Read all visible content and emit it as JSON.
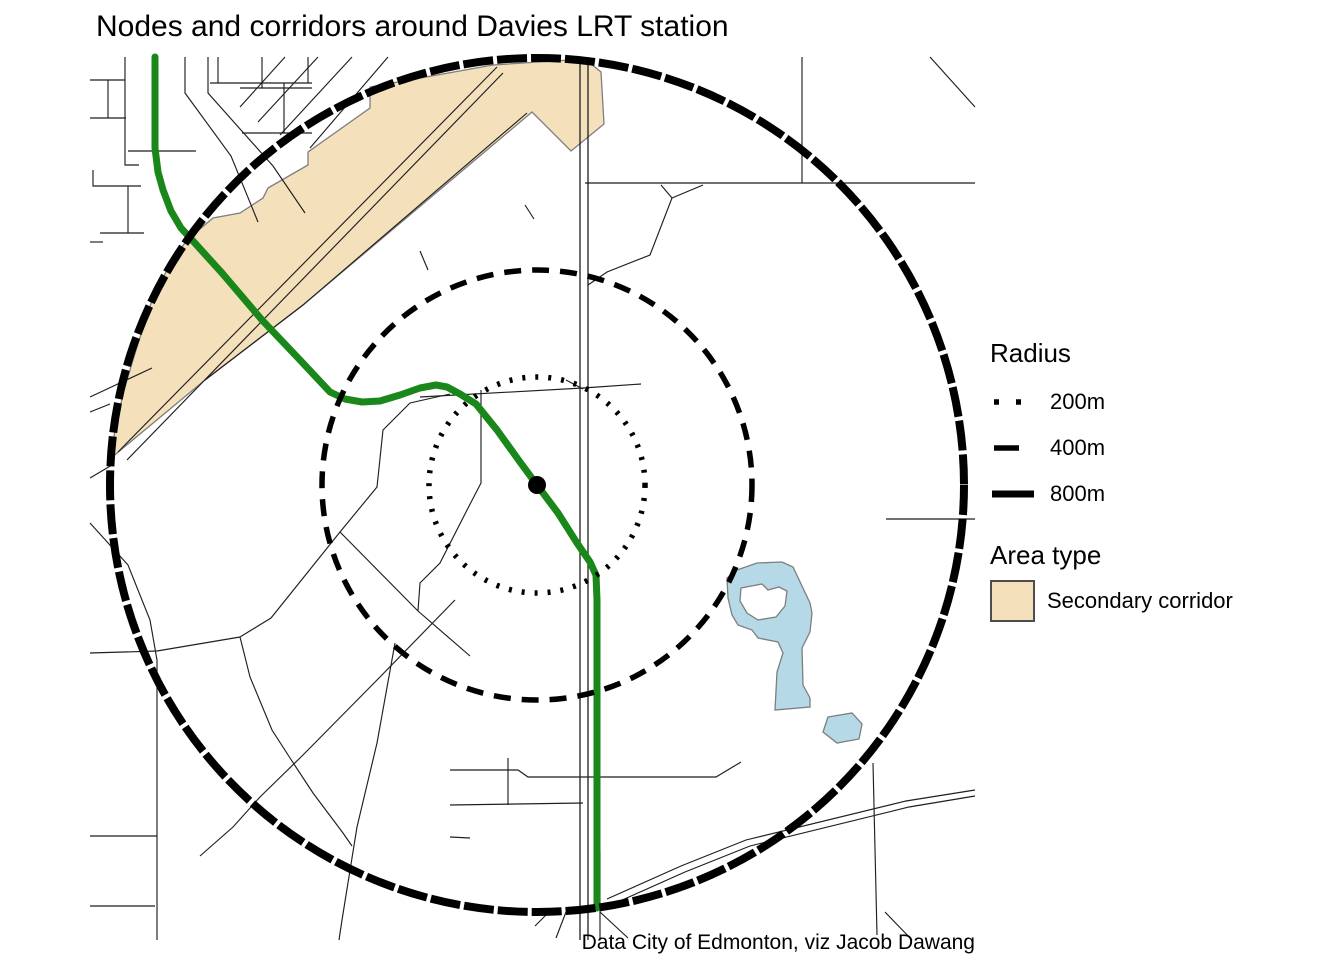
{
  "title": "Nodes and corridors around Davies LRT station",
  "caption": "Data City of Edmonton, viz Jacob Dawang",
  "legend": {
    "radius": {
      "title": "Radius",
      "items": [
        {
          "label": "200m",
          "style": "dotted"
        },
        {
          "label": "400m",
          "style": "dashed"
        },
        {
          "label": "800m",
          "style": "solid"
        }
      ]
    },
    "area_type": {
      "title": "Area type",
      "items": [
        {
          "label": "Secondary corridor",
          "fill": "#f4e1bc"
        }
      ]
    }
  },
  "chart_data": {
    "type": "map",
    "title": "Nodes and corridors around Davies LRT station",
    "station": {
      "name": "Davies LRT station",
      "x": 537,
      "y": 485,
      "marker": "black-dot"
    },
    "rings": [
      {
        "radius_m": 200,
        "style": "dotted",
        "r_px": 108
      },
      {
        "radius_m": 400,
        "style": "dashed",
        "r_px": 215
      },
      {
        "radius_m": 800,
        "style": "solid",
        "r_px": 427
      }
    ],
    "colors": {
      "corridor": "#f4e1bc",
      "water": "#b6d9e8",
      "lrt": "#198719",
      "road": "#1f1f1f",
      "ring": "#000000",
      "poly_border": "#7e7e7e"
    },
    "layers": {
      "secondary_corridor": [
        [
          [
            111,
            458
          ],
          [
            115,
            430
          ],
          [
            124,
            390
          ],
          [
            136,
            350
          ],
          [
            152,
            300
          ],
          [
            170,
            264
          ],
          [
            187,
            240
          ],
          [
            213,
            218
          ],
          [
            240,
            213
          ],
          [
            263,
            198
          ],
          [
            268,
            188
          ],
          [
            308,
            165
          ],
          [
            308,
            152
          ],
          [
            370,
            108
          ],
          [
            370,
            87
          ],
          [
            493,
            65
          ],
          [
            585,
            59
          ],
          [
            601,
            72
          ],
          [
            604,
            124
          ],
          [
            571,
            151
          ],
          [
            532,
            112
          ],
          [
            303,
            305
          ],
          [
            205,
            380
          ]
        ]
      ],
      "water": [
        {
          "outer": [
            [
              737,
              570
            ],
            [
              757,
              563
            ],
            [
              782,
              562
            ],
            [
              793,
              567
            ],
            [
              810,
              603
            ],
            [
              812,
              613
            ],
            [
              810,
              632
            ],
            [
              802,
              648
            ],
            [
              803,
              685
            ],
            [
              810,
              698
            ],
            [
              810,
              707
            ],
            [
              775,
              710
            ],
            [
              777,
              672
            ],
            [
              783,
              653
            ],
            [
              778,
              642
            ],
            [
              758,
              638
            ],
            [
              752,
              630
            ],
            [
              738,
              625
            ],
            [
              732,
              615
            ],
            [
              728,
              598
            ],
            [
              727,
              578
            ]
          ],
          "holes": [
            [
              [
                741,
                588
              ],
              [
                762,
                584
              ],
              [
                768,
                590
              ],
              [
                779,
                587
              ],
              [
                787,
                591
              ],
              [
                785,
                606
              ],
              [
                776,
                617
              ],
              [
                758,
                620
              ],
              [
                747,
                613
              ],
              [
                740,
                601
              ]
            ]
          ]
        },
        {
          "outer": [
            [
              828,
              717
            ],
            [
              852,
              713
            ],
            [
              862,
              724
            ],
            [
              859,
              739
            ],
            [
              837,
              743
            ],
            [
              823,
              732
            ]
          ],
          "holes": []
        }
      ],
      "roads": [
        [
          [
            90,
            80
          ],
          [
            125,
            80
          ]
        ],
        [
          [
            108,
            80
          ],
          [
            108,
            118
          ]
        ],
        [
          [
            90,
            118
          ],
          [
            126,
            118
          ]
        ],
        [
          [
            125,
            57
          ],
          [
            125,
            165
          ],
          [
            139,
            165
          ]
        ],
        [
          [
            93,
            170
          ],
          [
            93,
            186
          ],
          [
            141,
            186
          ]
        ],
        [
          [
            128,
            186
          ],
          [
            128,
            233
          ]
        ],
        [
          [
            100,
            233
          ],
          [
            144,
            233
          ]
        ],
        [
          [
            90,
            242
          ],
          [
            103,
            242
          ]
        ],
        [
          [
            128,
            151
          ],
          [
            196,
            151
          ]
        ],
        [
          [
            185,
            57
          ],
          [
            185,
            93
          ],
          [
            231,
            156
          ],
          [
            258,
            222
          ]
        ],
        [
          [
            208,
            57
          ],
          [
            208,
            93
          ],
          [
            273,
            166
          ],
          [
            305,
            213
          ]
        ],
        [
          [
            218,
            57
          ],
          [
            218,
            83
          ]
        ],
        [
          [
            210,
            83
          ],
          [
            312,
            83
          ]
        ],
        [
          [
            240,
            88
          ],
          [
            312,
            88
          ]
        ],
        [
          [
            262,
            57
          ],
          [
            262,
            88
          ]
        ],
        [
          [
            284,
            83
          ],
          [
            284,
            133
          ]
        ],
        [
          [
            242,
            133
          ],
          [
            312,
            133
          ]
        ],
        [
          [
            308,
            57
          ],
          [
            308,
            83
          ]
        ],
        [
          [
            285,
            57
          ],
          [
            240,
            107
          ]
        ],
        [
          [
            318,
            57
          ],
          [
            258,
            122
          ]
        ],
        [
          [
            352,
            57
          ],
          [
            280,
            135
          ]
        ],
        [
          [
            388,
            57
          ],
          [
            310,
            148
          ]
        ],
        [
          [
            118,
            452
          ],
          [
            497,
            67
          ]
        ],
        [
          [
            127,
            460
          ],
          [
            503,
            73
          ]
        ],
        [
          [
            420,
            251
          ],
          [
            428,
            270
          ]
        ],
        [
          [
            525,
            205
          ],
          [
            534,
            219
          ]
        ],
        [
          [
            205,
            380
          ],
          [
            303,
            305
          ],
          [
            527,
            113
          ]
        ],
        [
          [
            420,
            397
          ],
          [
            583,
            388
          ],
          [
            641,
            384
          ]
        ],
        [
          [
            566,
            380
          ],
          [
            583,
            389
          ]
        ],
        [
          [
            481,
            390
          ],
          [
            481,
            483
          ],
          [
            466,
            512
          ],
          [
            440,
            563
          ],
          [
            420,
            583
          ],
          [
            418,
            611
          ]
        ],
        [
          [
            450,
            394
          ],
          [
            410,
            403
          ],
          [
            383,
            430
          ],
          [
            377,
            487
          ],
          [
            340,
            532
          ],
          [
            271,
            618
          ],
          [
            240,
            637
          ],
          [
            250,
            677
          ],
          [
            272,
            730
          ],
          [
            290,
            758
          ],
          [
            313,
            793
          ],
          [
            343,
            833
          ],
          [
            352,
            846
          ]
        ],
        [
          [
            340,
            532
          ],
          [
            418,
            611
          ],
          [
            470,
            656
          ]
        ],
        [
          [
            455,
            600
          ],
          [
            380,
            677
          ],
          [
            303,
            755
          ],
          [
            260,
            797
          ],
          [
            233,
            827
          ],
          [
            200,
            856
          ]
        ],
        [
          [
            395,
            643
          ],
          [
            377,
            743
          ],
          [
            357,
            827
          ],
          [
            342,
            920
          ],
          [
            339,
            940
          ]
        ],
        [
          [
            588,
            285
          ],
          [
            607,
            272
          ],
          [
            650,
            255
          ],
          [
            672,
            198
          ],
          [
            661,
            185
          ]
        ],
        [
          [
            672,
            198
          ],
          [
            703,
            185
          ]
        ],
        [
          [
            585,
            183
          ],
          [
            975,
            183
          ]
        ],
        [
          [
            802,
            57
          ],
          [
            802,
            183
          ]
        ],
        [
          [
            930,
            57
          ],
          [
            975,
            107
          ]
        ],
        [
          [
            886,
            519
          ],
          [
            975,
            519
          ]
        ],
        [
          [
            90,
            397
          ],
          [
            152,
            368
          ]
        ],
        [
          [
            90,
            412
          ],
          [
            110,
            404
          ]
        ],
        [
          [
            90,
            478
          ],
          [
            112,
            465
          ]
        ],
        [
          [
            90,
            523
          ],
          [
            128,
            565
          ],
          [
            150,
            620
          ],
          [
            157,
            660
          ],
          [
            157,
            940
          ]
        ],
        [
          [
            90,
            653
          ],
          [
            157,
            651
          ],
          [
            240,
            637
          ]
        ],
        [
          [
            90,
            836
          ],
          [
            157,
            836
          ]
        ],
        [
          [
            90,
            906
          ],
          [
            155,
            906
          ]
        ],
        [
          [
            450,
            770
          ],
          [
            518,
            770
          ],
          [
            528,
            777
          ],
          [
            716,
            777
          ],
          [
            741,
            762
          ]
        ],
        [
          [
            450,
            805
          ],
          [
            583,
            803
          ]
        ],
        [
          [
            508,
            758
          ],
          [
            508,
            805
          ]
        ],
        [
          [
            450,
            837
          ],
          [
            470,
            838
          ]
        ],
        [
          [
            553,
            908
          ],
          [
            535,
            926
          ]
        ],
        [
          [
            566,
            912
          ],
          [
            556,
            938
          ]
        ],
        [
          [
            600,
            852
          ],
          [
            600,
            940
          ]
        ],
        [
          [
            600,
            912
          ],
          [
            628,
            938
          ]
        ],
        [
          [
            607,
            899
          ],
          [
            681,
            866
          ],
          [
            746,
            840
          ],
          [
            906,
            801
          ],
          [
            975,
            790
          ]
        ],
        [
          [
            611,
            905
          ],
          [
            685,
            872
          ],
          [
            750,
            846
          ],
          [
            909,
            807
          ],
          [
            975,
            796
          ]
        ],
        [
          [
            873,
            763
          ],
          [
            877,
            935
          ]
        ],
        [
          [
            885,
            912
          ],
          [
            912,
            940
          ]
        ]
      ],
      "rail": [
        [
          [
            580,
            57
          ],
          [
            580,
            940
          ]
        ],
        [
          [
            588,
            57
          ],
          [
            588,
            940
          ]
        ]
      ],
      "lrt_line": [
        [
          155,
          57
        ],
        [
          155,
          148
        ],
        [
          158,
          172
        ],
        [
          163,
          190
        ],
        [
          171,
          211
        ],
        [
          181,
          228
        ],
        [
          193,
          241
        ],
        [
          222,
          273
        ],
        [
          262,
          320
        ],
        [
          300,
          360
        ],
        [
          330,
          392
        ],
        [
          345,
          399
        ],
        [
          362,
          402
        ],
        [
          380,
          401
        ],
        [
          400,
          395
        ],
        [
          420,
          388
        ],
        [
          436,
          385
        ],
        [
          447,
          387
        ],
        [
          460,
          394
        ],
        [
          476,
          404
        ],
        [
          497,
          430
        ],
        [
          520,
          462
        ],
        [
          537,
          485
        ],
        [
          558,
          513
        ],
        [
          577,
          543
        ],
        [
          590,
          562
        ],
        [
          596,
          575
        ],
        [
          597,
          600
        ],
        [
          597,
          908
        ]
      ]
    }
  }
}
